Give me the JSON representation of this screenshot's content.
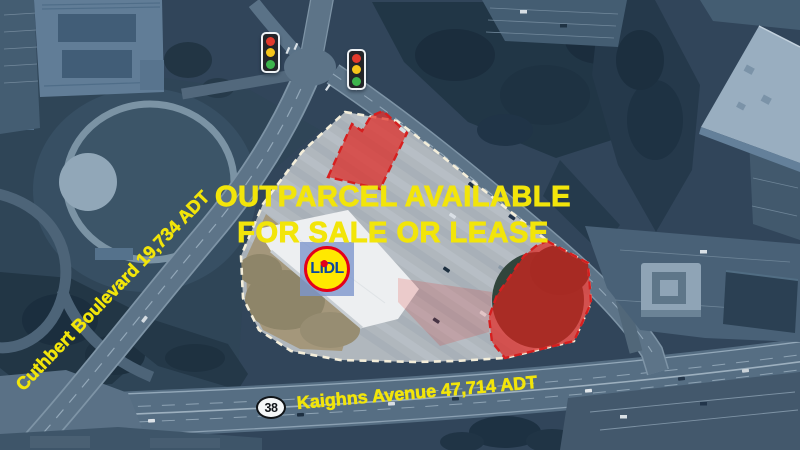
{
  "headline": {
    "line1": "OUTPARCEL AVAILABLE",
    "line2": "FOR SALE OR LEASE"
  },
  "road_labels": {
    "cuthbert": "Cuthbert Boulevard 19,734 ADT",
    "kaighns": "Kaighns Avenue 47,714 ADT"
  },
  "route_shield": {
    "number": "38"
  },
  "brand_logo": {
    "text": "LiDL"
  },
  "map_features": {
    "outparcels": [
      "north-outparcel",
      "southeast-outparcel"
    ],
    "icons": [
      "traffic-light-icon",
      "traffic-light-icon",
      "route-shield-icon",
      "lidl-logo"
    ]
  },
  "colors": {
    "accent_yellow": "#f2e50a",
    "parcel_red": "#d61f1f",
    "parcel_red_fill": "rgba(227,33,27,0.68)",
    "boundary_dash": "#f4eeda",
    "lidl_yellow": "#ffe800",
    "lidl_blue": "#0a47a0",
    "lidl_red": "#e3001b"
  }
}
